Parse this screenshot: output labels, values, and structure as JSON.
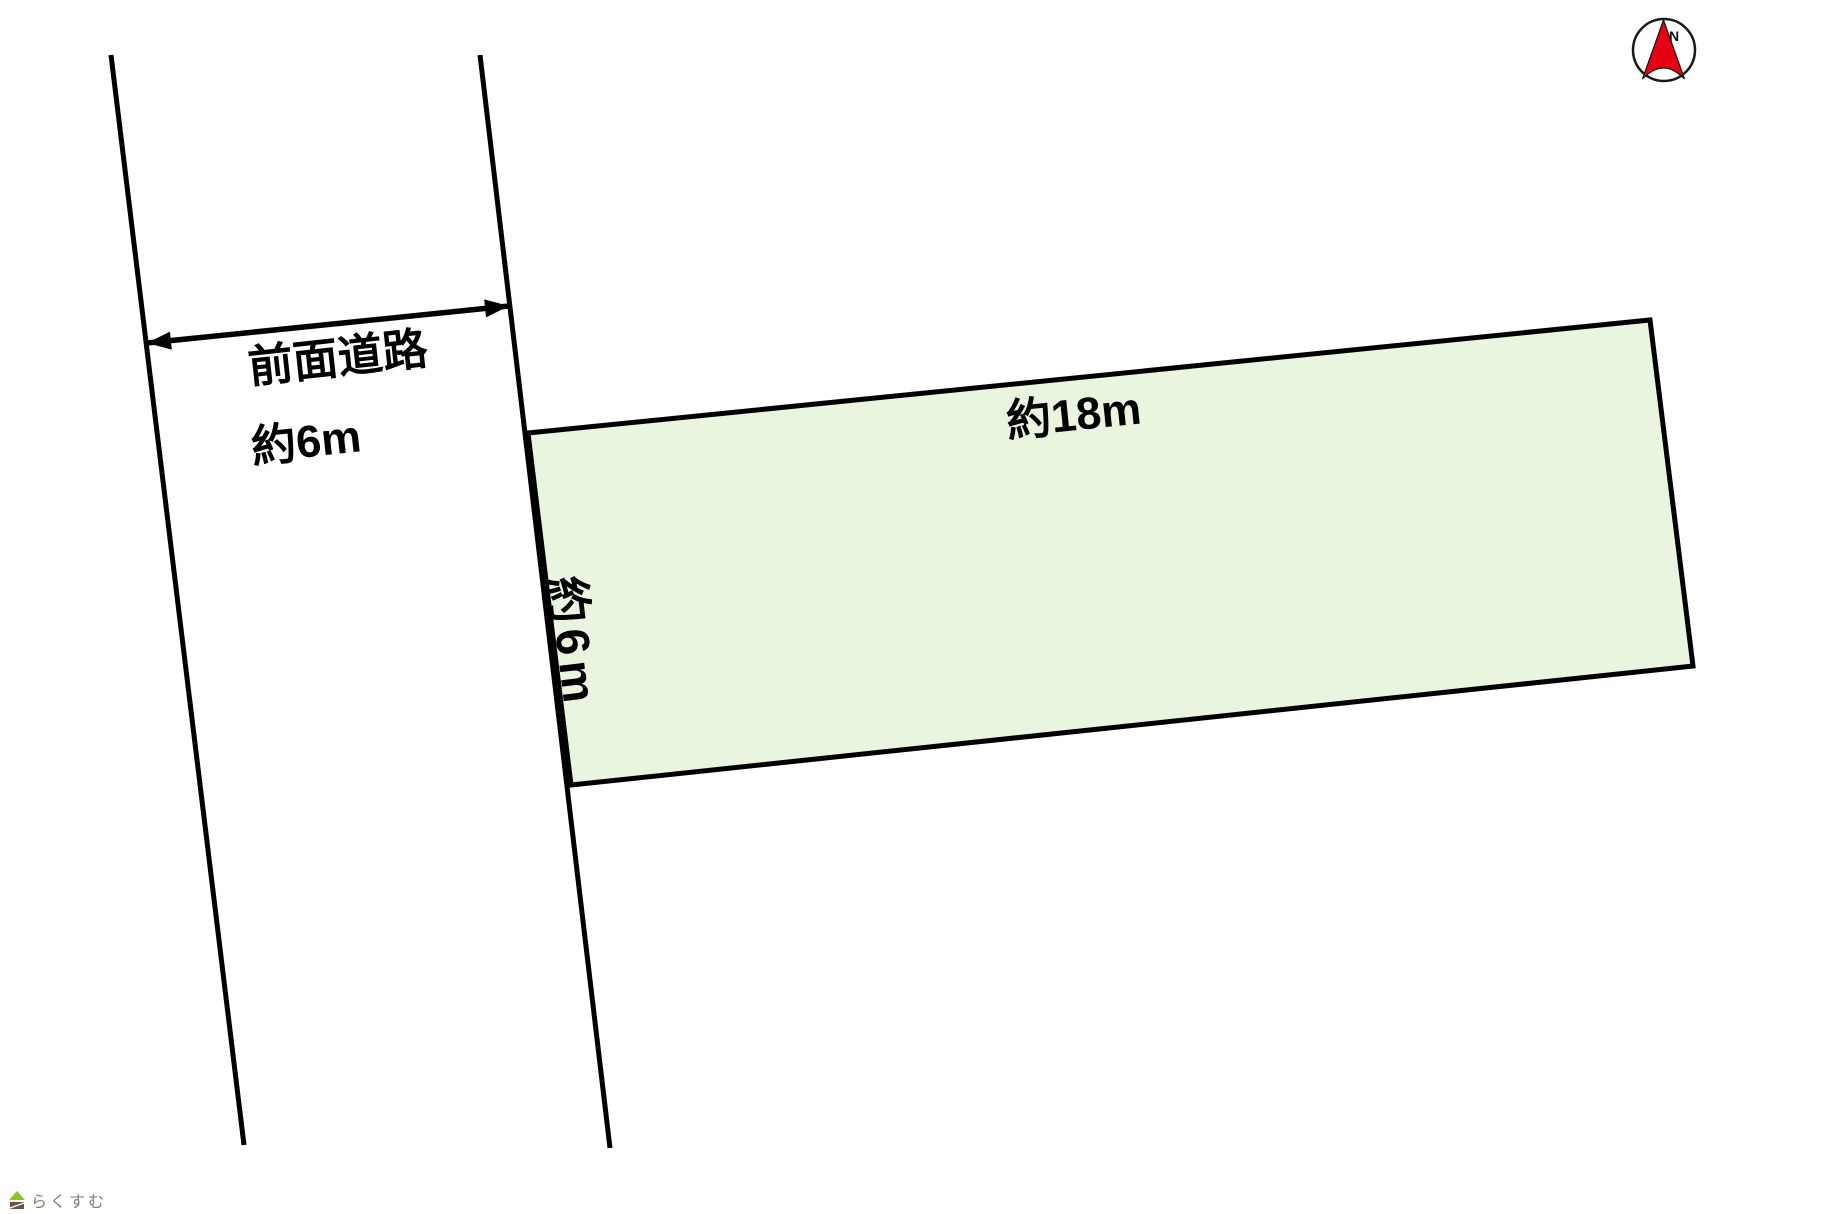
{
  "page": {
    "background_color": "#ffffff"
  },
  "plot_diagram": {
    "road": {
      "name_label": "前面道路",
      "width_label": "約6m"
    },
    "parcel": {
      "width_label": "約18m",
      "frontage_label": "約6m",
      "fill_color": "#e9f5df",
      "outline_color": "#000000"
    },
    "compass": {
      "north_label": "N",
      "needle_color": "#e60012",
      "ring_color": "#1a1a1a"
    },
    "watermark": {
      "text": "らくすむ",
      "text_color": "#8d7b6e",
      "icon_roof_color": "#8fc31f",
      "icon_body_color": "#6f5243"
    }
  }
}
